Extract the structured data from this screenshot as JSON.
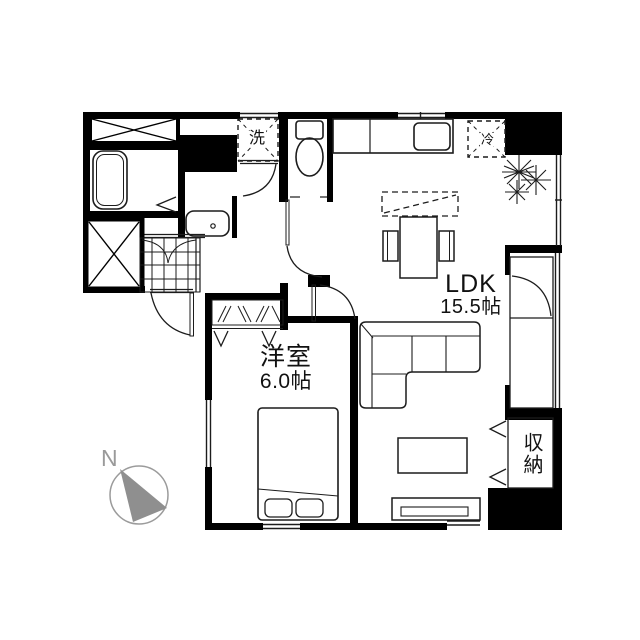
{
  "plan_title": "apartment-floor-plan",
  "rooms": {
    "ldk": {
      "name": "LDK",
      "size": "15.5帖"
    },
    "bedroom": {
      "name": "洋室",
      "size": "6.0帖"
    },
    "storage": {
      "name": "収納"
    }
  },
  "appliances": {
    "washing_machine": "洗",
    "refrigerator": "冷"
  },
  "compass": {
    "north": "N"
  },
  "colors": {
    "wall": "#000000",
    "line": "#1c1c1c",
    "compass_gray": "#8f8f8f",
    "background": "#ffffff"
  }
}
